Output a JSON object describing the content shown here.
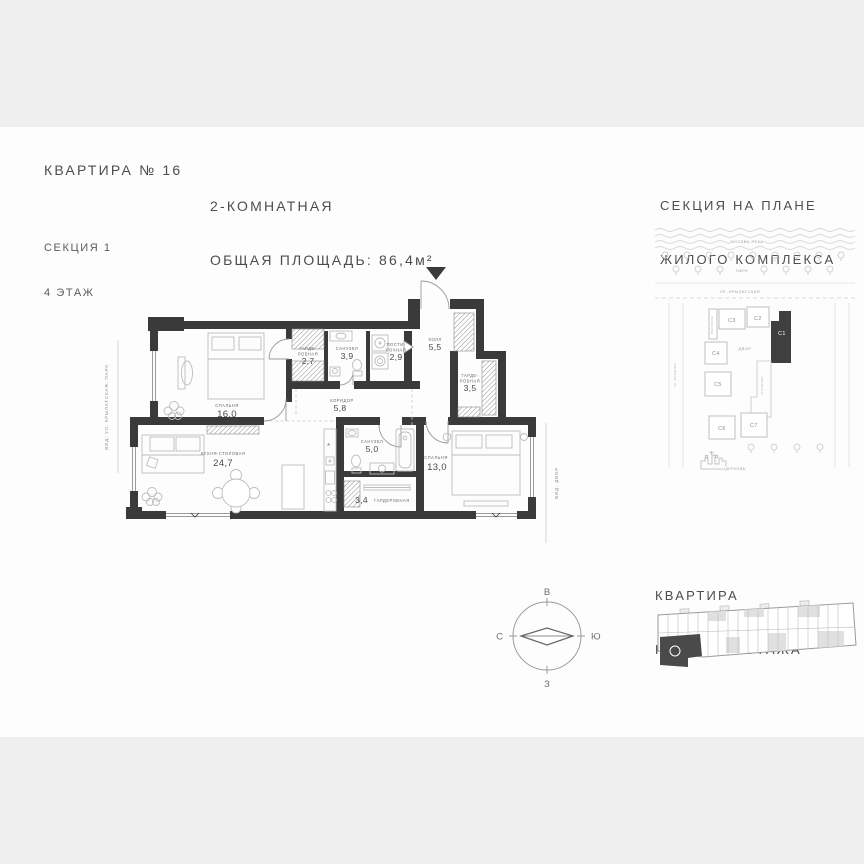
{
  "header": {
    "apartment_title": "КВАРТИРА № 16",
    "section_line1": "СЕКЦИЯ 1",
    "section_line2": "4 ЭТАЖ",
    "type_label": "2-КОМНАТНАЯ",
    "total_area_label": "ОБЩАЯ ПЛОЩАДЬ: 86,4м²"
  },
  "site_plan": {
    "title_line1": "СЕКЦИЯ НА ПЛАНЕ",
    "title_line2": "ЖИЛОГО КОМПЛЕКСА",
    "river_label": "МОСКВА РЕКА",
    "park_label": "ПАРК",
    "street_top": "УЛ. КРЫЛАТСКАЯ",
    "street_left": "УЛ. ОСЕННЯЯ",
    "restaurant_label": "РЕСТОРАН",
    "courtyard_label": "ДВОР",
    "stylobate_label": "СТИЛОБАТ",
    "church_label": "ЦЕРКОВЬ",
    "buildings": [
      "С3",
      "С2",
      "С1",
      "С4",
      "С5",
      "С6",
      "С7"
    ],
    "highlighted_building": "С1",
    "highlight_color": "#3f3f3f"
  },
  "floor_plan": {
    "wall_color": "#3a3a3a",
    "view_left": "ВИД: УЛ. КРЫЛАТСКАЯ. ПАРК",
    "view_right": "ВИД: ДВОР",
    "rooms": [
      {
        "id": "bedroom-1",
        "label_lines": [
          "СПАЛЬНЯ"
        ],
        "area": "16,0"
      },
      {
        "id": "wardrobe-1",
        "label_lines": [
          "ГАРДЕ-",
          "РОБНАЯ"
        ],
        "area": "2,7"
      },
      {
        "id": "bathroom-1",
        "label_lines": [
          "САНУЗЕЛ"
        ],
        "area": "3,9"
      },
      {
        "id": "laundry",
        "label_lines": [
          "ПОСТИ-",
          "РОЧНАЯ"
        ],
        "area": "2,9"
      },
      {
        "id": "hall",
        "label_lines": [
          "ХОЛЛ"
        ],
        "area": "5,5"
      },
      {
        "id": "wardrobe-2",
        "label_lines": [
          "ГАРДЕ-",
          "РОБНАЯ"
        ],
        "area": "3,5"
      },
      {
        "id": "corridor",
        "label_lines": [
          "КОРИДОР"
        ],
        "area": "5,8"
      },
      {
        "id": "kitchen",
        "label_lines": [
          "КУХНЯ-СТОЛОВАЯ"
        ],
        "area": "24,7"
      },
      {
        "id": "bathroom-2",
        "label_lines": [
          "САНУЗЕЛ"
        ],
        "area": "5,0"
      },
      {
        "id": "wardrobe-3",
        "label_lines": [
          "ГАРДЕРОБНАЯ"
        ],
        "area": "3,4"
      },
      {
        "id": "bedroom-2",
        "label_lines": [
          "СПАЛЬНЯ"
        ],
        "area": "13,0"
      }
    ]
  },
  "compass": {
    "top": "В",
    "right": "Ю",
    "bottom": "З",
    "left": "С"
  },
  "floor_strip": {
    "title_line1": "КВАРТИРА",
    "title_line2": "НА ПЛАНЕ ЭТАЖА"
  }
}
